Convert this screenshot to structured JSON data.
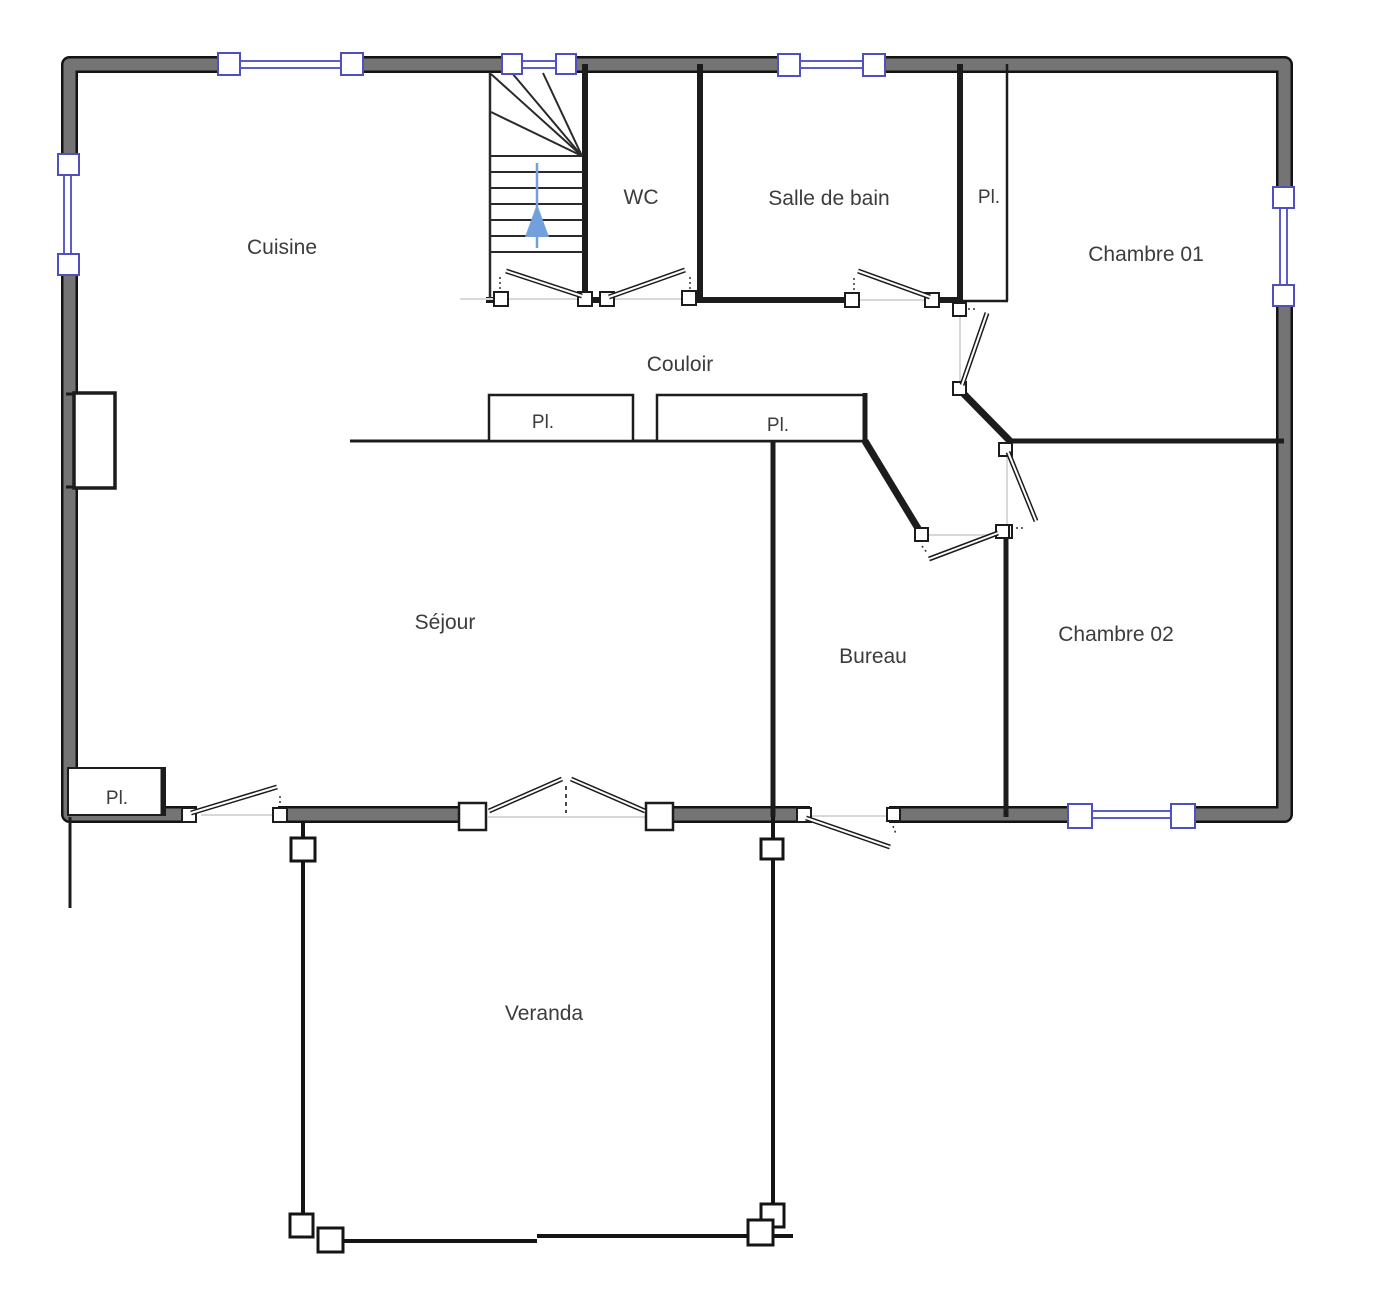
{
  "floorplan": {
    "title": "Floor plan (ground floor)",
    "rooms": {
      "cuisine": {
        "label": "Cuisine"
      },
      "wc": {
        "label": "WC"
      },
      "salle_de_bain": {
        "label": "Salle de bain"
      },
      "pl_haut": {
        "label": "Pl."
      },
      "chambre01": {
        "label": "Chambre 01"
      },
      "couloir": {
        "label": "Couloir"
      },
      "pl_couloir_1": {
        "label": "Pl."
      },
      "pl_couloir_2": {
        "label": "Pl."
      },
      "sejour": {
        "label": "Séjour"
      },
      "bureau": {
        "label": "Bureau"
      },
      "chambre02": {
        "label": "Chambre 02"
      },
      "pl_entree": {
        "label": "Pl."
      },
      "veranda": {
        "label": "Veranda"
      }
    },
    "stairs": {
      "direction": "up"
    },
    "colors": {
      "outer_wall_fill": "#747474",
      "outer_wall_edge": "#131313",
      "interior_wall": "#1c1c1c",
      "window_blue": "#5c5ccb",
      "door_opening_gray": "#d8d8d8",
      "stairs_arrow_blue": "#71a0dd",
      "label_text": "#3c3c3c"
    }
  }
}
